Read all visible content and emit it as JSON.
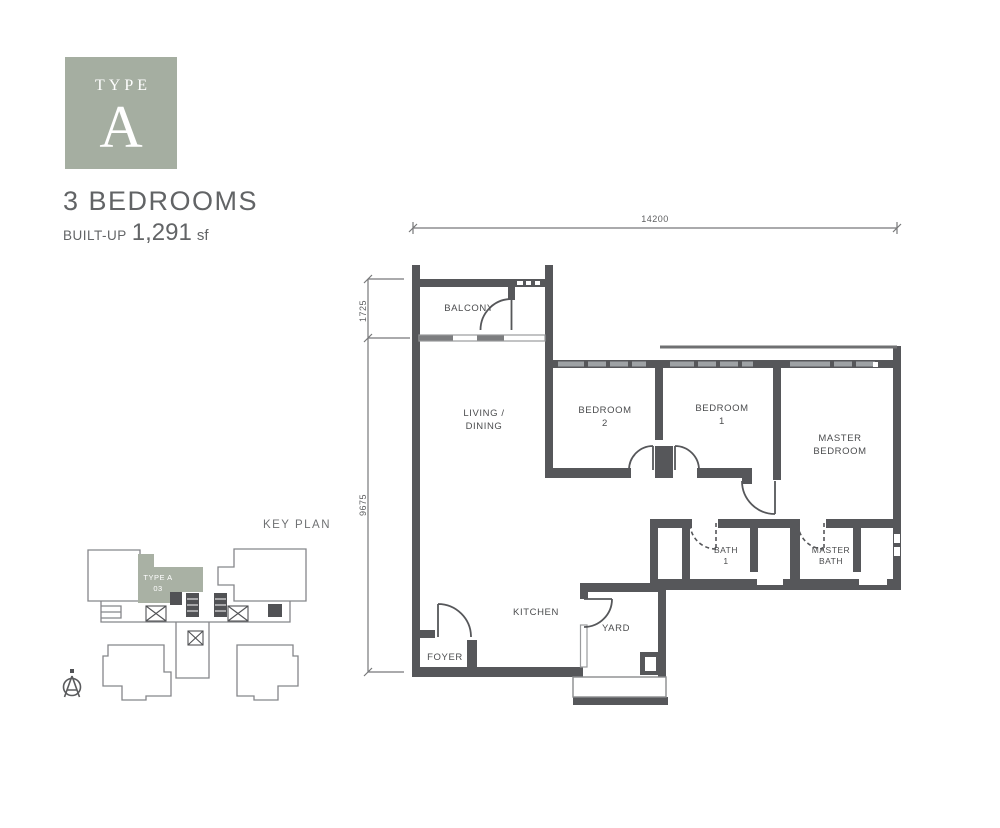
{
  "header": {
    "type_label": "TYPE",
    "type_letter": "A",
    "bedrooms_title": "3 BEDROOMS",
    "built_up_label": "BUILT-UP",
    "built_up_value": "1,291",
    "built_up_unit": "sf"
  },
  "floor_plan": {
    "dimensions": {
      "total_width": "14200",
      "balcony_depth": "1725",
      "body_depth": "9675"
    },
    "rooms": {
      "balcony": "BALCONY",
      "living_dining": {
        "line1": "LIVING /",
        "line2": "DINING"
      },
      "bedroom2": {
        "line1": "BEDROOM",
        "line2": "2"
      },
      "bedroom1": {
        "line1": "BEDROOM",
        "line2": "1"
      },
      "master_bedroom": {
        "line1": "MASTER",
        "line2": "BEDROOM"
      },
      "bath1": {
        "line1": "BATH",
        "line2": "1"
      },
      "master_bath": {
        "line1": "MASTER",
        "line2": "BATH"
      },
      "kitchen": "KITCHEN",
      "yard": "YARD",
      "foyer": "FOYER"
    }
  },
  "key_plan": {
    "title": "KEY PLAN",
    "highlighted_unit": {
      "line1": "TYPE A",
      "line2": "03"
    },
    "north_indicator": "A"
  },
  "colors": {
    "accent_green": "#a5aea1",
    "keyplan_unit_green": "#a9b1a4",
    "wall_gray": "#56575a",
    "outline_gray": "#85868a",
    "text_gray": "#626466",
    "label_gray": "#4b4c4e"
  }
}
